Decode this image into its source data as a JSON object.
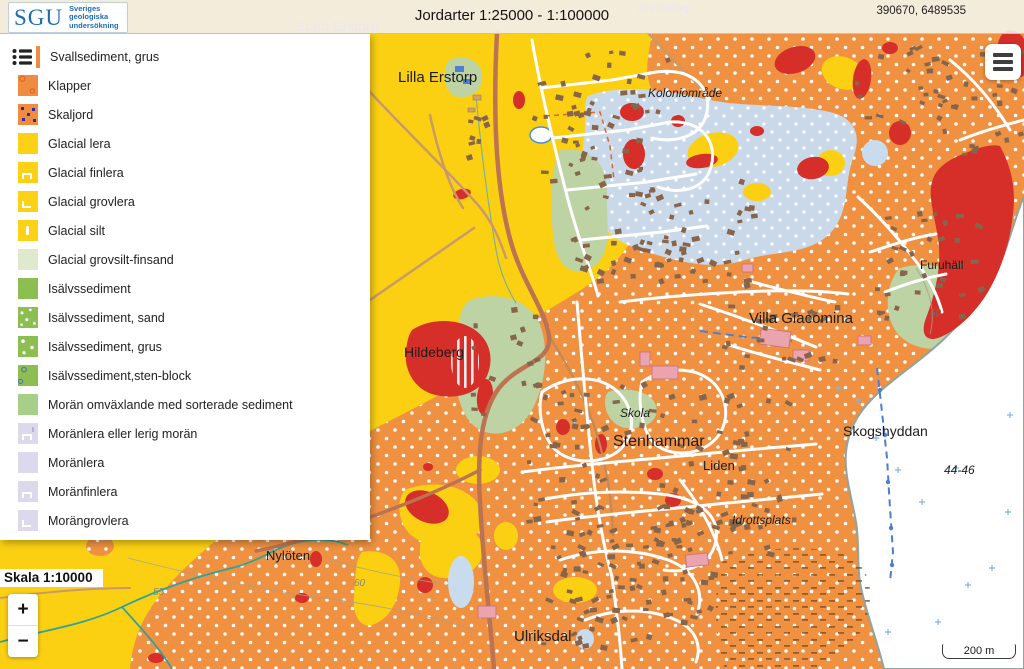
{
  "header": {
    "logo_text": "SGU",
    "logo_tagline": "Sveriges\ngeologiska\nundersökning",
    "title": "Jordarter 1:25000 - 1:100000",
    "coordinates": "390670, 6489535"
  },
  "legend": {
    "items": [
      {
        "label": "Svallsediment, grus",
        "swatch": "sw-orange",
        "first": true
      },
      {
        "label": "Klapper",
        "swatch": "sw-orange-circles"
      },
      {
        "label": "Skaljord",
        "swatch": "sw-orange-squares"
      },
      {
        "label": "Glacial lera",
        "swatch": "sw-yellow"
      },
      {
        "label": "Glacial finlera",
        "swatch": "sw-yellow mark-n"
      },
      {
        "label": "Glacial grovlera",
        "swatch": "sw-yellow mark-l"
      },
      {
        "label": "Glacial silt",
        "swatch": "sw-yellow mark-bar"
      },
      {
        "label": "Glacial grovsilt-finsand",
        "swatch": "sw-palegreen"
      },
      {
        "label": "Isälvssediment",
        "swatch": "sw-green"
      },
      {
        "label": "Isälvssediment, sand",
        "swatch": "sw-green-dots"
      },
      {
        "label": "Isälvssediment, grus",
        "swatch": "sw-green-grus"
      },
      {
        "label": "Isälvssediment,sten-block",
        "swatch": "sw-green-blocks"
      },
      {
        "label": "Morän omväxlande med sorterade sediment",
        "swatch": "sw-morangreen"
      },
      {
        "label": "Moränlera eller lerig morän",
        "swatch": "sw-lav mark-n mark-tick"
      },
      {
        "label": "Moränlera",
        "swatch": "sw-lav"
      },
      {
        "label": "Moränfinlera",
        "swatch": "sw-lav mark-n"
      },
      {
        "label": "Morängrovlera",
        "swatch": "sw-lav mark-l"
      }
    ]
  },
  "scale_label": "Skala 1:10000",
  "zoom_controls": {
    "zoom_in": "+",
    "zoom_out": "−"
  },
  "scale_bar": {
    "label": "200 m"
  },
  "map": {
    "labels": [
      {
        "text": "Stora Erstorp",
        "x": 296,
        "y": 31,
        "size": 14,
        "color": "#93a7b6"
      },
      {
        "text": "Arvidstorp",
        "x": 638,
        "y": 12,
        "size": 12,
        "color": "#93a7b6"
      },
      {
        "text": "Lilla Erstorp",
        "x": 398,
        "y": 82,
        "size": 15
      },
      {
        "text": "Koloniområde",
        "x": 648,
        "y": 97,
        "size": 12,
        "italic": true
      },
      {
        "text": "Hildeberg",
        "x": 404,
        "y": 357,
        "size": 14
      },
      {
        "text": "Villa Giacomina",
        "x": 749,
        "y": 323,
        "size": 15
      },
      {
        "text": "Skola",
        "x": 620,
        "y": 417,
        "size": 12,
        "italic": true
      },
      {
        "text": "Stenhammar",
        "x": 613,
        "y": 446,
        "size": 16
      },
      {
        "text": "Liden",
        "x": 703,
        "y": 470,
        "size": 13
      },
      {
        "text": "Skogshyddan",
        "x": 843,
        "y": 436,
        "size": 14
      },
      {
        "text": "44-46",
        "x": 944,
        "y": 474,
        "size": 12,
        "italic": true
      },
      {
        "text": "Idrottsplats",
        "x": 732,
        "y": 524,
        "size": 12,
        "italic": true
      },
      {
        "text": "Nylöten",
        "x": 266,
        "y": 560,
        "size": 13
      },
      {
        "text": "Furuhäll",
        "x": 920,
        "y": 269,
        "size": 12
      },
      {
        "text": "Ulriksdal",
        "x": 514,
        "y": 641,
        "size": 15
      },
      {
        "text": "55",
        "x": 153,
        "y": 595,
        "size": 10,
        "color": "#8a8a74",
        "italic": true
      },
      {
        "text": "60",
        "x": 354,
        "y": 586,
        "size": 10,
        "color": "#8a8a74",
        "italic": true
      },
      {
        "text": "50",
        "x": 930,
        "y": 316,
        "size": 10,
        "color": "#7c6c5c",
        "italic": true
      }
    ]
  },
  "colors": {
    "map_orange": "#ef9140",
    "map_yellow": "#fbd013",
    "bedrock_red": "#d62e28",
    "glaciofluvial_blue": "#c9d9ea",
    "water_white": "#ffffff",
    "legend_orange": "#ef8c40",
    "legend_yellow": "#fcd116",
    "legend_green": "#8cbe52",
    "legend_lavender": "#dcd9ec",
    "logo_blue": "#1f6cb5"
  }
}
